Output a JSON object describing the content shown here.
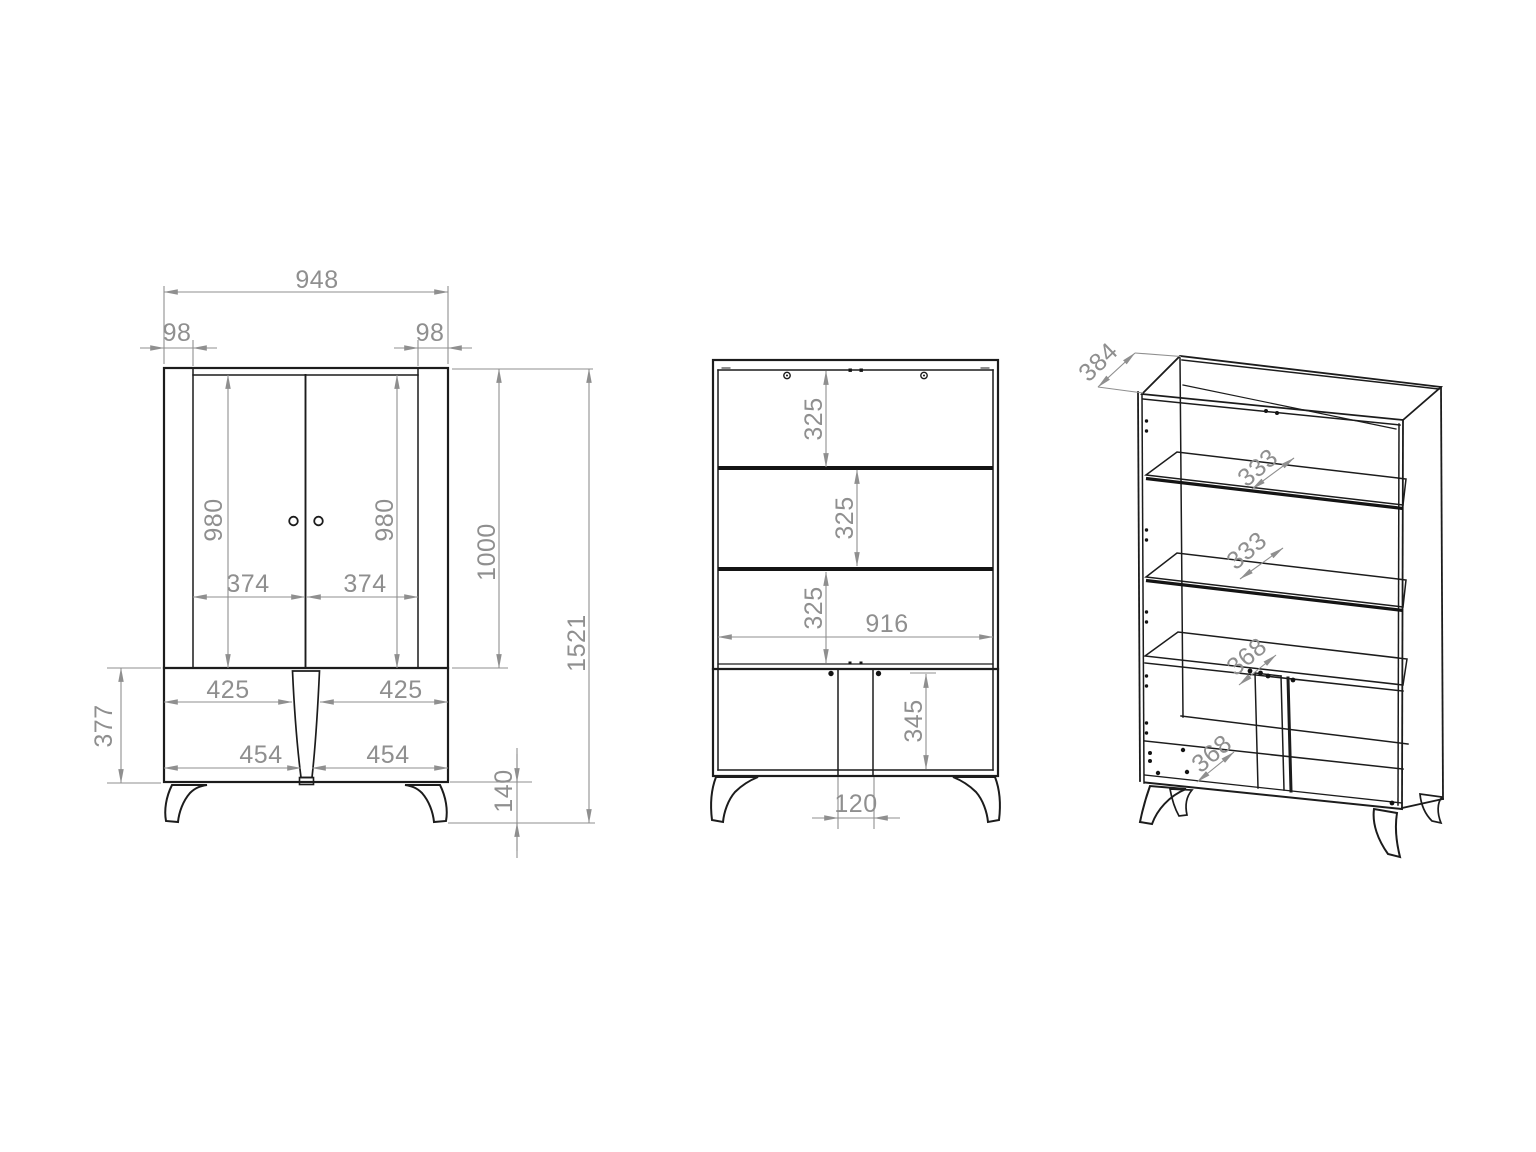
{
  "drawing": {
    "type": "furniture-dimension-drawing",
    "units": "mm",
    "colors": {
      "outline": "#1c1c1c",
      "dimension": "#8f8f8f",
      "background": "#ffffff"
    }
  },
  "front_view": {
    "overall_width": "948",
    "left_side_panel": "98",
    "right_side_panel": "98",
    "left_door_height": "980",
    "right_door_height": "980",
    "left_door_width": "374",
    "right_door_width": "374",
    "upper_section_height": "1000",
    "overall_height": "1521",
    "base_left_opening_width": "425",
    "base_right_opening_width": "425",
    "base_left_door_width": "454",
    "base_right_door_width": "454",
    "base_section_height": "377",
    "leg_height": "140"
  },
  "internal_view": {
    "top_shelf_spacing": "325",
    "middle_shelf_spacing": "325",
    "bottom_shelf_spacing": "325",
    "internal_width": "916",
    "base_compartment_height": "345",
    "center_divider_width": "120"
  },
  "isometric_view": {
    "cabinet_depth": "384",
    "upper_glass_shelf_depth": "333",
    "lower_glass_shelf_depth": "333",
    "fixed_shelf_depth": "368",
    "bottom_panel_depth": "368"
  }
}
